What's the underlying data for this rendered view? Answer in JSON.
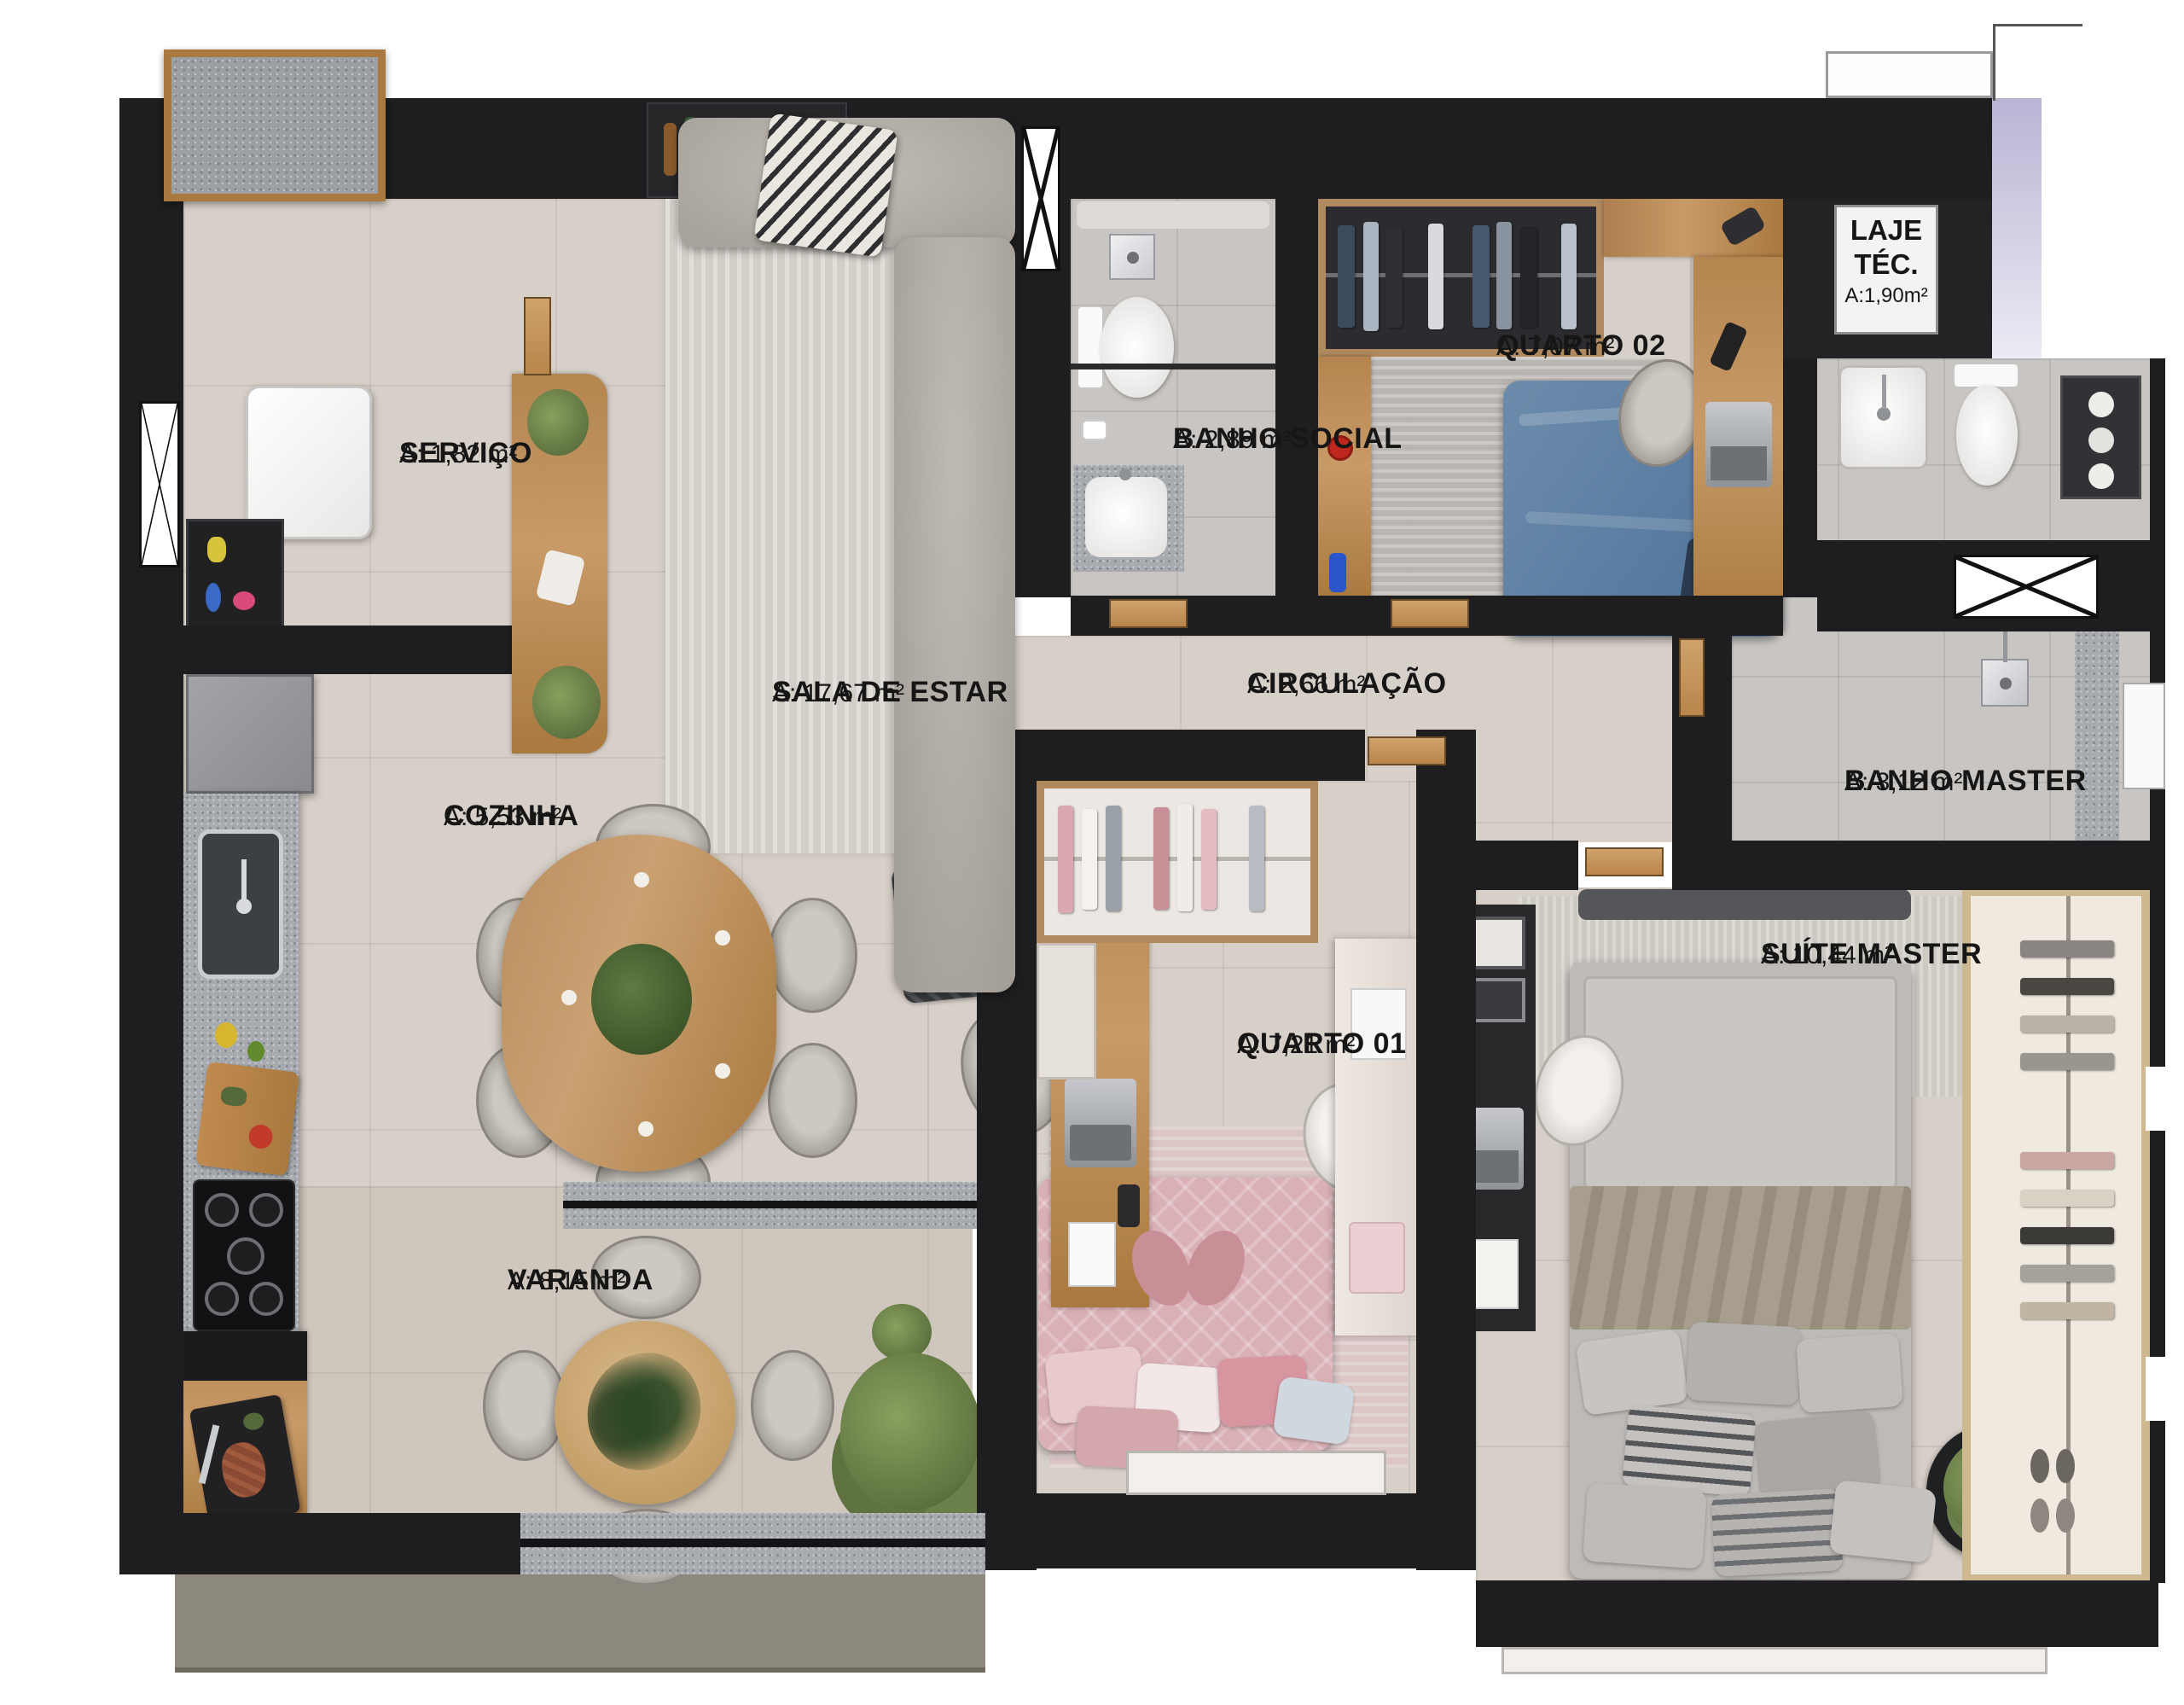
{
  "rooms": {
    "servico": {
      "name": "SERVIÇO",
      "area": "A: 1,82 m²"
    },
    "sala": {
      "name": "SALA DE ESTAR",
      "area": "A: 17,67 m²"
    },
    "cozinha": {
      "name": "COZINHA",
      "area": "A: 5,53 m²"
    },
    "banho_social": {
      "name": "BANHO SOCIAL",
      "area": "A: 2,89 m²"
    },
    "quarto02": {
      "name": "QUARTO 02",
      "area": "A: 7,07 m²"
    },
    "laje": {
      "name": "LAJE",
      "name2": "TÉC.",
      "area": "A:1,90m²"
    },
    "circulacao": {
      "name": "CIRCULAÇÃO",
      "area": "A: 2,66 m²"
    },
    "banho_master": {
      "name": "BANHO MASTER",
      "area": "A: 3,12 m²"
    },
    "quarto01": {
      "name": "QUARTO 01",
      "area": "A: 7,21 m²"
    },
    "suite": {
      "name": "SUÍTE MASTER",
      "area": "A: 10,44 m²"
    },
    "varanda": {
      "name": "VARANDA",
      "area": "A: 8,15 m²"
    }
  },
  "colors": {
    "wall": "#1e1e20",
    "floor": "#d7d0c8",
    "bath_floor": "#c8c5c2",
    "granite": "#a7abb0",
    "wood": "#b5854f",
    "bed_blue": "#5e80a4",
    "bed_pink": "#d9b0b5",
    "bed_gray": "#bdbab7",
    "label_text": "#161616"
  }
}
